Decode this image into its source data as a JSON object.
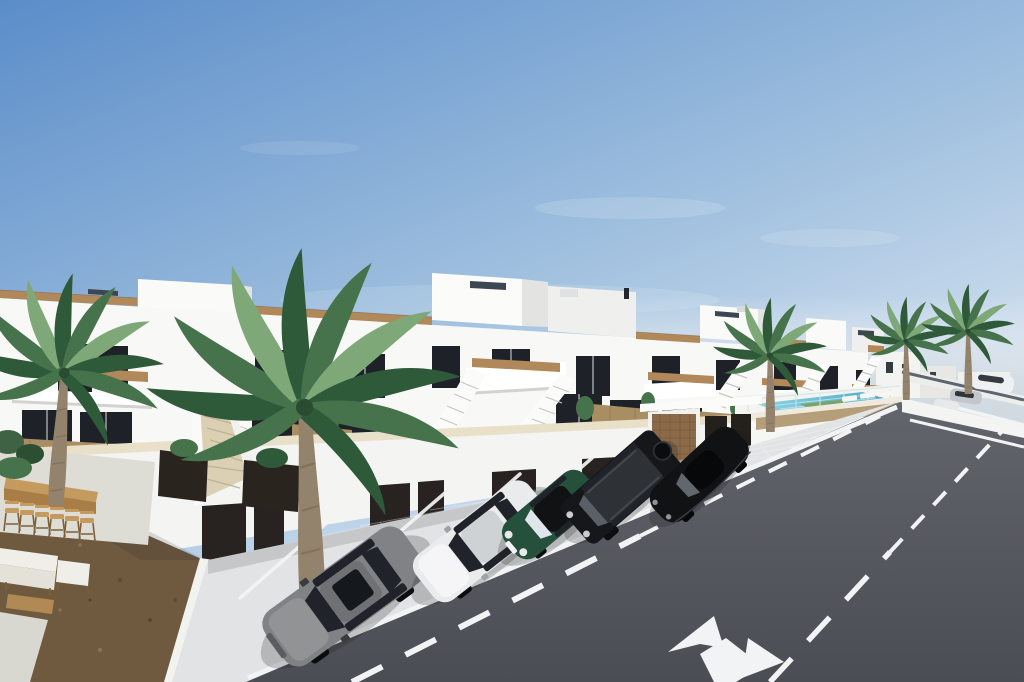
{
  "meta": {
    "description": "Photorealistic 3D exterior render of a new-build coastal residential development: a receding row of two-storey white townhouses with roof terraces, external staircases, street-level garages, angled parking with five cars, a communal pool, palm trees and an asphalt road with lane markings.",
    "image_type": "architectural render",
    "width": 1024,
    "height": 682
  },
  "palette": {
    "sky_top": "#5b8dc9",
    "sky_mid": "#9dbede",
    "sky_horizon": "#e9eff6",
    "sea_haze": "#d5dde4",
    "land_haze": "#a2aaa0",
    "cloud": "#f4f7fa",
    "facade_white": "#f8f8f6",
    "facade_shade": "#e2e3e1",
    "window_glass": "#1e2228",
    "reed_tan": "#b0885a",
    "reed_fence": "#a98e63",
    "coping_beige": "#e9e0ca",
    "slat_wood": "#8a6a48",
    "panel_dark": "#24201c",
    "garage_door": "#282320",
    "pavement": "#e2e3e5",
    "marking_white": "#f1f3f4",
    "road_top": "#63656c",
    "road_bottom": "#4b4d54",
    "pool_light": "#8fd4e2",
    "pool_deep": "#4fa8c8",
    "lawn_green": "#7ba36b",
    "palm_green": "#47734c",
    "palm_green_dark": "#2f5a39",
    "palm_green_light": "#7ea878",
    "palm_trunk": "#93836c",
    "gravel": "#6f5a40",
    "wood_counter": "#c59a5f",
    "wood_counter_front": "#a87e46",
    "sofa_white": "#efeee8",
    "steps_beige": "#dcd0b4",
    "car_gray": "#808285",
    "car_white": "#e9ebed",
    "car_green": "#25503c",
    "car_black": "#15171a",
    "car_coupe": "#101214",
    "car_glass": "#20242a",
    "solar_panel": "#3d4752"
  },
  "scene": {
    "setting": "sunny day, clear blue sky fading to pale haze at the horizon",
    "buildings": {
      "type": "row of two-storey white townhouses receding to the right",
      "features": [
        "roof terraces with cane balustrades",
        "first-floor balconies with cane railing strips",
        "external white staircases",
        "ground-floor terraces with cane privacy fencing",
        "dark-framed glazed doors and windows",
        "street-level garages with dark doors",
        "solar panels and AC units on roofs"
      ]
    },
    "vehicles": [
      {
        "name": "grey sedan",
        "color": "#808285"
      },
      {
        "name": "white sedan",
        "color": "#e9ebed"
      },
      {
        "name": "dark green mini with black roof",
        "color": "#25503c"
      },
      {
        "name": "black boxy suv",
        "color": "#15171a"
      },
      {
        "name": "black coupe",
        "color": "#101214"
      },
      {
        "name": "four distant parked cars",
        "color": "mixed white / silver / dark"
      }
    ],
    "vegetation": [
      "large palm tree front-left",
      "second palm at far left edge",
      "palm beside the pool",
      "two palms far right",
      "shrubs, terrace plants and dark planter boxes"
    ],
    "amenities": [
      "wooden bar counter with six stools",
      "white lounge sofa set with coffee table",
      "gravel landscaped garden",
      "communal swimming pool with glass fence and sun loungers"
    ],
    "road": {
      "surface": "dark asphalt",
      "markings": [
        "solid white edge line",
        "two dashed white lane lines",
        "white split lane arrow"
      ],
      "parking": "angled bays marked with white lines on light pavers"
    }
  }
}
